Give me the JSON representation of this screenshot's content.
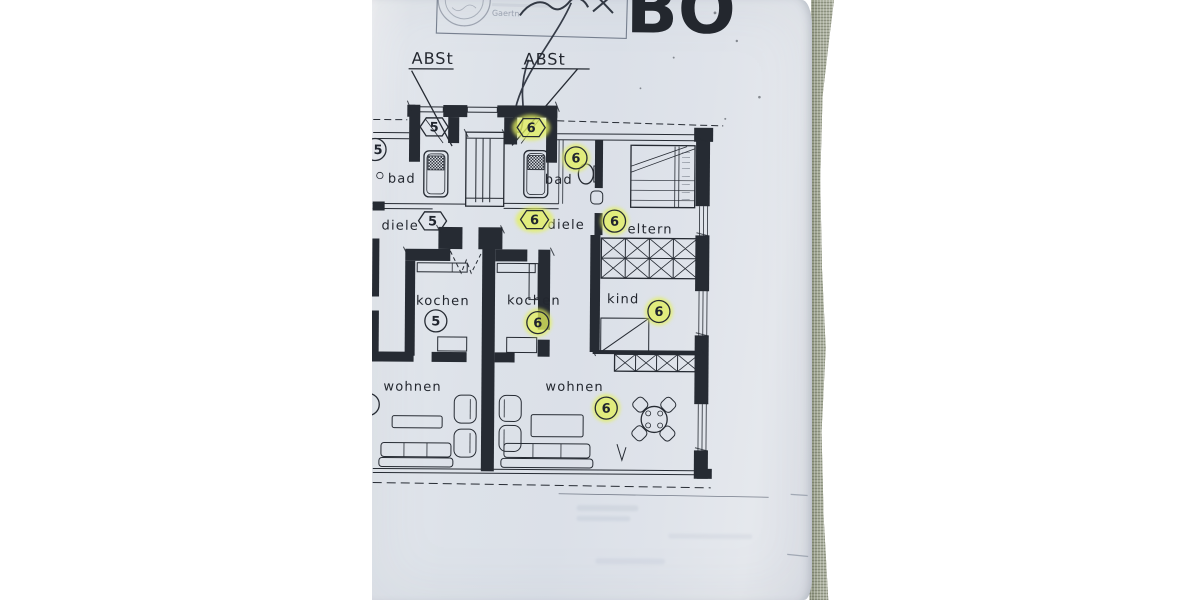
{
  "photo": {
    "header": {
      "plan_letters": "BO",
      "stamp_text": "Gaertn"
    },
    "callouts": {
      "abst_left": "ABSt",
      "abst_right": "ABSt"
    },
    "rooms": {
      "bad_left": "bad",
      "bad_right": "bad",
      "diele_left": "diele",
      "diele_right": "diele",
      "eltern": "eltern",
      "kochen_left": "kochen",
      "kochen_right": "kochen",
      "kind": "kind",
      "wohnen_left": "wohnen",
      "wohnen_right": "wohnen"
    },
    "badges": [
      {
        "id": "abst-5",
        "value": "5",
        "shape": "hexagon",
        "highlighted": false
      },
      {
        "id": "abst-6",
        "value": "6",
        "shape": "hexagon",
        "highlighted": true
      },
      {
        "id": "bad-5",
        "value": "5",
        "shape": "circle",
        "highlighted": false
      },
      {
        "id": "bad-6",
        "value": "6",
        "shape": "circle",
        "highlighted": true
      },
      {
        "id": "diele-5",
        "value": "5",
        "shape": "hexagon",
        "highlighted": false
      },
      {
        "id": "diele-6",
        "value": "6",
        "shape": "hexagon",
        "highlighted": true
      },
      {
        "id": "eltern-6",
        "value": "6",
        "shape": "circle",
        "highlighted": true
      },
      {
        "id": "kochen-5",
        "value": "5",
        "shape": "circle",
        "highlighted": false
      },
      {
        "id": "kochen-6",
        "value": "6",
        "shape": "circle",
        "highlighted": true
      },
      {
        "id": "kind-6",
        "value": "6",
        "shape": "circle",
        "highlighted": true
      },
      {
        "id": "wohnen-6",
        "value": "6",
        "shape": "circle",
        "highlighted": true
      }
    ],
    "colors": {
      "ink": "#262b33",
      "paper": "#dde2e9",
      "highlight": "#e3f05e",
      "fabric": "#a3a896"
    }
  }
}
